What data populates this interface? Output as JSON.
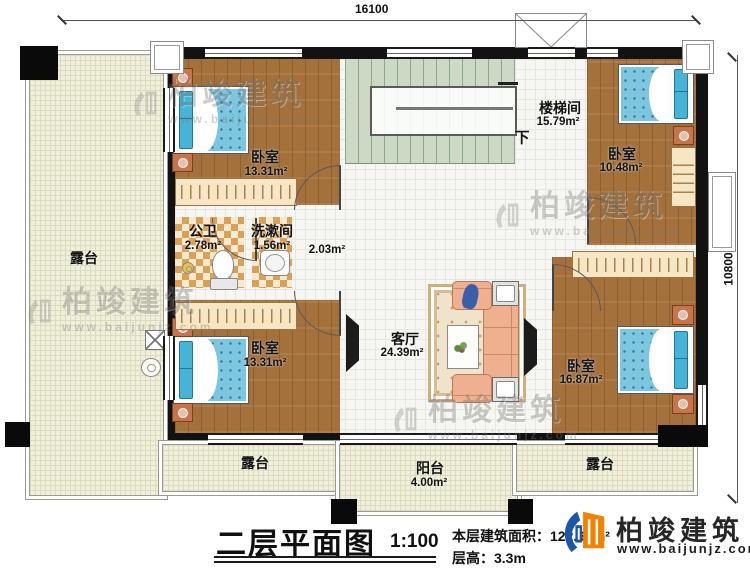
{
  "dimensions": {
    "width_mm": "16100",
    "height_mm": "10800"
  },
  "rooms": [
    {
      "id": "bedroom-top-left",
      "label": "卧室",
      "area": "13.31m²"
    },
    {
      "id": "bedroom-bottom-left",
      "label": "卧室",
      "area": "13.31m²"
    },
    {
      "id": "bathroom",
      "label": "公卫",
      "area": "2.78m²"
    },
    {
      "id": "washroom",
      "label": "洗漱间",
      "area": "1.56m²"
    },
    {
      "id": "corridor",
      "label": "",
      "area": "2.03m²"
    },
    {
      "id": "stairwell",
      "label": "楼梯间",
      "area": "15.79m²",
      "down": "下"
    },
    {
      "id": "bedroom-top-right",
      "label": "卧室",
      "area": "10.48m²"
    },
    {
      "id": "living-room",
      "label": "客厅",
      "area": "24.39m²"
    },
    {
      "id": "bedroom-bottom-right",
      "label": "卧室",
      "area": "16.87m²"
    },
    {
      "id": "terrace-left",
      "label": "露台"
    },
    {
      "id": "terrace-bottom-left",
      "label": "露台"
    },
    {
      "id": "balcony",
      "label": "阳台",
      "area": "4.00m²"
    },
    {
      "id": "terrace-bottom-right",
      "label": "露台"
    }
  ],
  "watermark": {
    "brand": "柏竣建筑",
    "url": "www.baijunjz.com"
  },
  "title_block": {
    "title": "二层平面图",
    "scale": "1:100",
    "area_label": "本层建筑面积：",
    "area_value": "122.65m²",
    "floor_height_label": "层高：",
    "floor_height_value": "3.3m"
  },
  "logo": {
    "brand": "柏竣建筑",
    "url": "www.baijunjz.com"
  },
  "colors": {
    "wall": "#121212",
    "wood_floor": "#a4713c",
    "stair": "#ccd9c4",
    "mattress_blue": "#7cc6e0",
    "logo_blue": "#1a57a8",
    "logo_orange": "#f08300"
  }
}
